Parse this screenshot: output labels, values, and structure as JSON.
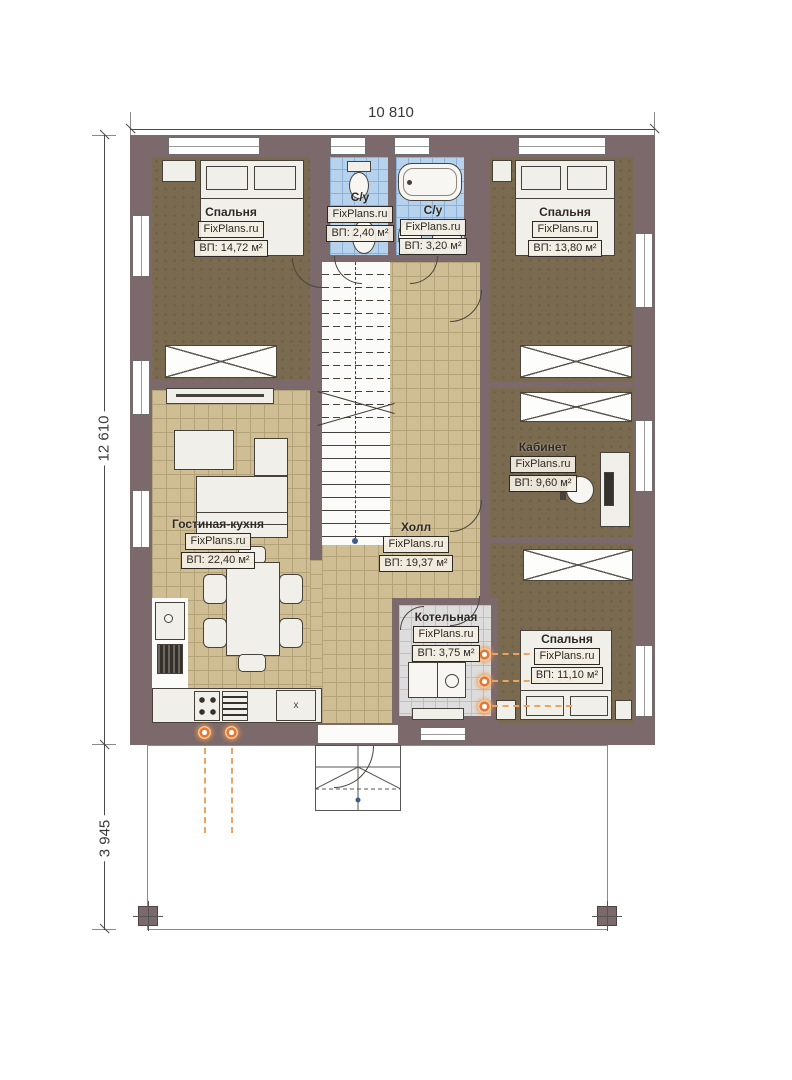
{
  "plan": {
    "brand": "FixPlans.ru",
    "dimensions": {
      "top": "10 810",
      "left": "12 610",
      "terrace": "3 945"
    },
    "rooms": [
      {
        "id": "bedroom-top-left",
        "name": "Спальня",
        "watermark": "FixPlans.ru",
        "area": "ВП: 14,72 м²"
      },
      {
        "id": "bathroom-left",
        "name": "С/у",
        "watermark": "FixPlans.ru",
        "area": "ВП: 2,40 м²"
      },
      {
        "id": "bathroom-right",
        "name": "С/у",
        "watermark": "FixPlans.ru",
        "area": "ВП: 3,20 м²"
      },
      {
        "id": "bedroom-top-right",
        "name": "Спальня",
        "watermark": "FixPlans.ru",
        "area": "ВП: 13,80 м²"
      },
      {
        "id": "living-kitchen",
        "name": "Гостиная-кухня",
        "watermark": "FixPlans.ru",
        "area": "ВП: 22,40 м²"
      },
      {
        "id": "hall",
        "name": "Холл",
        "watermark": "FixPlans.ru",
        "area": "ВП: 19,37 м²"
      },
      {
        "id": "cabinet",
        "name": "Кабинет",
        "watermark": "FixPlans.ru",
        "area": "ВП: 9,60 м²"
      },
      {
        "id": "boiler-room",
        "name": "Котельная",
        "watermark": "FixPlans.ru",
        "area": "ВП: 3,75 м²"
      },
      {
        "id": "bedroom-bottom-right",
        "name": "Спальня",
        "watermark": "FixPlans.ru",
        "area": "ВП: 11,10 м²"
      }
    ],
    "kitchen": {
      "sink_label": "x"
    },
    "colors": {
      "wall": "#7c696b",
      "floor_wood": "#7a6a4f",
      "floor_tile_tan": "#cfbd93",
      "floor_tile_blue": "#b7d2ec",
      "floor_tile_gray": "#dddddd",
      "accent_orange": "#e07a35"
    },
    "icons": [
      "bed-icon",
      "wardrobe-icon",
      "bathtub-icon",
      "toilet-icon",
      "washbasin-icon",
      "sofa-icon",
      "tv-console-icon",
      "coffee-table-icon",
      "dining-table-icon",
      "chair-icon",
      "stove-icon",
      "fridge-icon",
      "sink-icon",
      "desk-icon",
      "office-chair-icon",
      "stairs-icon",
      "boiler-icon",
      "radiator-icon",
      "window-icon",
      "door-arc-icon",
      "porch-steps-icon",
      "post-icon"
    ]
  }
}
